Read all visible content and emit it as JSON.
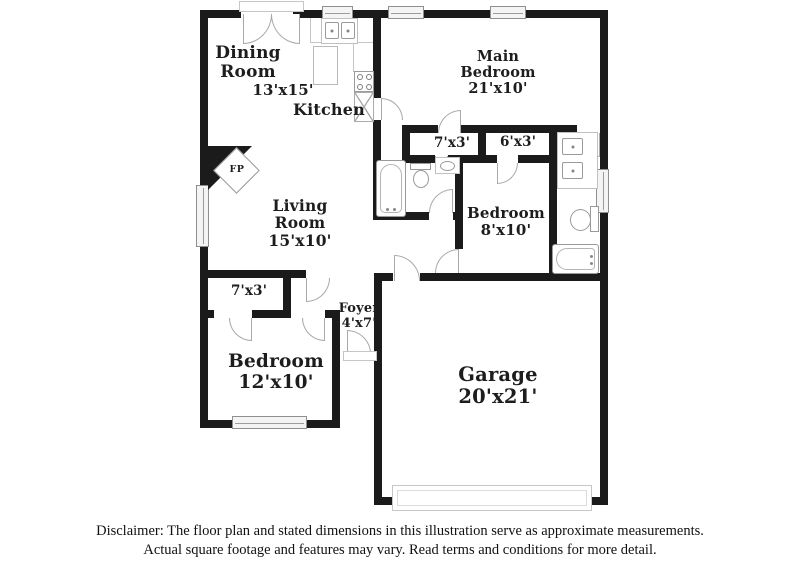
{
  "colors": {
    "wall": "#1b1b1b",
    "fixture_outline": "#9a9a9a",
    "text": "#1d1d1d",
    "window_fill": "#f4f4f4"
  },
  "rooms": {
    "dining": {
      "line1": "Dining",
      "line2": "Room",
      "dims": "13'x15'"
    },
    "kitchen": {
      "name": "Kitchen"
    },
    "main_bedroom": {
      "line1": "Main",
      "line2": "Bedroom",
      "dims": "21'x10'"
    },
    "living_room": {
      "line1": "Living",
      "line2": "Room",
      "dims": "15'x10'"
    },
    "bedroom_8x10": {
      "name": "Bedroom",
      "dims": "8'x10'"
    },
    "bedroom_12x10": {
      "name": "Bedroom",
      "dims": "12'x10'"
    },
    "garage": {
      "name": "Garage",
      "dims": "20'x21'"
    },
    "foyer": {
      "name": "Foyer",
      "dims": "4'x7'"
    },
    "closet_hall": {
      "dims": "7'x3'"
    },
    "closet_bedroom2": {
      "dims": "6'x3'"
    },
    "closet_bedroom3": {
      "dims": "7'x3'"
    },
    "fireplace": {
      "label": "FP"
    }
  },
  "disclaimer": {
    "line1": "Disclaimer: The floor plan and stated dimensions in this illustration serve as approximate measurements.",
    "line2": "Actual square footage and features may vary. Read terms and conditions for more detail."
  }
}
